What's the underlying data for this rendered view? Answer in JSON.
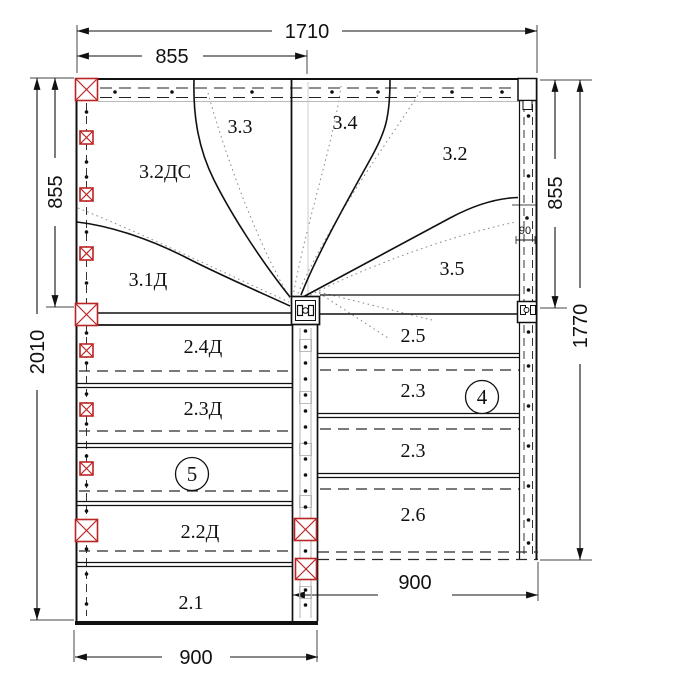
{
  "drawing": {
    "colors": {
      "accent_red": "#bb2424",
      "line": "#111111",
      "walkline_gray": "#8a8a8a"
    },
    "winder": {
      "s33": "3.3",
      "s34": "3.4",
      "s32ds": "3.2ДС",
      "s32": "3.2",
      "s31d": "3.1Д",
      "s35": "3.5"
    },
    "left_flight": {
      "r1": "2.4Д",
      "r2": "2.3Д",
      "r3": "2.2Д",
      "r4": "2.1",
      "marker": "5"
    },
    "right_flight": {
      "r1": "2.5",
      "r2": "2.3",
      "r3": "2.3",
      "r4": "2.6",
      "marker": "4"
    },
    "dims": {
      "top_total": "1710",
      "top_half": "855",
      "left_upper": "855",
      "left_total": "2010",
      "right_upper": "855",
      "right_total": "1770",
      "wall": "90",
      "bottom_left": "900",
      "bottom_right": "900"
    }
  }
}
